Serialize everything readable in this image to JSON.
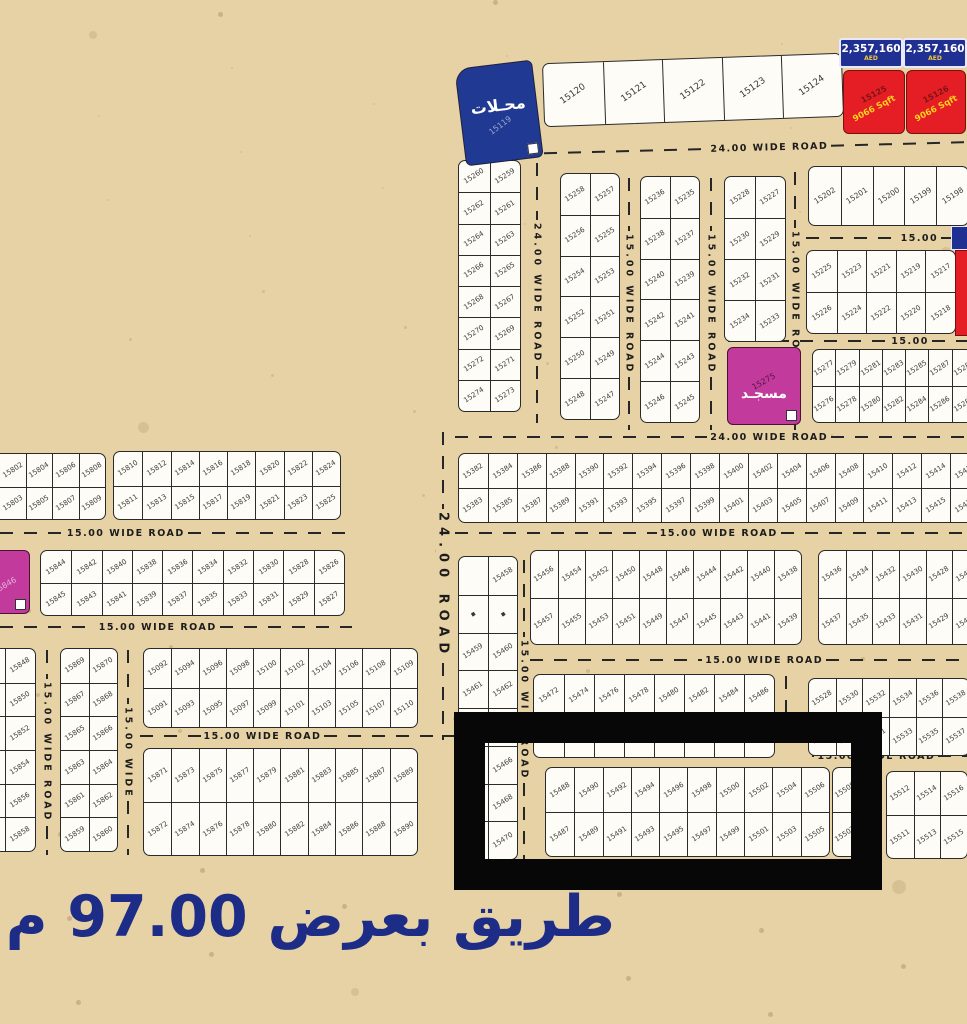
{
  "map": {
    "width": 967,
    "height": 1024,
    "bg_color": "#e7d2a5",
    "plot_color": "#fdfcf6",
    "accent_navy": "#203092",
    "accent_red": "#e41e24",
    "accent_magenta": "#c23a9c"
  },
  "caption": {
    "text": "طريق بعرض 97.00 م",
    "color": "#1c2c87"
  },
  "shops": {
    "label": "محـلات",
    "num": "15119",
    "x": 460,
    "y": 64,
    "w": 78,
    "h": 98,
    "rot": -7
  },
  "mosque": {
    "label": "مسجـد",
    "num": "15275",
    "x": 727,
    "y": 347,
    "w": 74,
    "h": 78,
    "rot": 0
  },
  "facility": {
    "num": "15846",
    "x": -20,
    "y": 550,
    "w": 50,
    "h": 64,
    "rot": 0
  },
  "red_plots": [
    {
      "num": "15125",
      "area": "9066 Sqft",
      "x": 843,
      "y": 70,
      "w": 62,
      "h": 64
    },
    {
      "num": "15126",
      "area": "9066 Sqft",
      "x": 906,
      "y": 70,
      "w": 60,
      "h": 64
    }
  ],
  "prices": [
    {
      "amount": "2,357,160",
      "currency": "AED",
      "x": 839,
      "y": 38,
      "w": 64,
      "h": 30
    },
    {
      "amount": "2,357,160",
      "currency": "AED",
      "x": 903,
      "y": 38,
      "w": 64,
      "h": 30
    }
  ],
  "edge_plot": {
    "tag": {
      "x": 951,
      "y": 226,
      "w": 16,
      "h": 22
    },
    "red": {
      "x": 955,
      "y": 250,
      "w": 12,
      "h": 84
    }
  },
  "highlight_frame": {
    "x": 454,
    "y": 712,
    "w": 428,
    "h": 178
  },
  "roads": [
    {
      "o": "h",
      "x": 520,
      "y": 148,
      "len": 447,
      "label": "24.00 WIDE ROAD",
      "lx": 58,
      "rot": -1.5
    },
    {
      "o": "h",
      "x": 455,
      "y": 437,
      "len": 512,
      "label": "24.00 WIDE ROAD",
      "lx": 65
    },
    {
      "o": "v",
      "x": 537,
      "y": 163,
      "len": 260,
      "label": "24.00 WIDE ROAD"
    },
    {
      "o": "v",
      "x": 629,
      "y": 178,
      "len": 252,
      "label": "15.00 WIDE ROAD"
    },
    {
      "o": "v",
      "x": 711,
      "y": 178,
      "len": 252,
      "label": "15.00 WIDE ROAD"
    },
    {
      "o": "v",
      "x": 795,
      "y": 172,
      "len": 258,
      "label": "15.00 WIDE ROAD"
    },
    {
      "o": "h",
      "x": 806,
      "y": 238,
      "len": 161,
      "label": "15.00",
      "lx": 78
    },
    {
      "o": "h",
      "x": 728,
      "y": 341,
      "len": 239,
      "label": "15.00",
      "lx": 82
    },
    {
      "o": "h",
      "x": 0,
      "y": 533,
      "len": 352,
      "label": "15.00 WIDE ROAD",
      "lx": 28
    },
    {
      "o": "h",
      "x": 0,
      "y": 627,
      "len": 352,
      "label": "15.00 WIDE ROAD",
      "lx": 42
    },
    {
      "o": "v",
      "x": 47,
      "y": 650,
      "len": 205,
      "label": "15.00 WIDE ROAD"
    },
    {
      "o": "v",
      "x": 128,
      "y": 650,
      "len": 205,
      "label": "15.00 WIDE"
    },
    {
      "o": "h",
      "x": 140,
      "y": 736,
      "len": 340,
      "label": "15.00 WIDE ROAD",
      "lx": 28
    },
    {
      "o": "v",
      "x": 443,
      "y": 432,
      "len": 308,
      "label": "24.00 ROAD",
      "big": true
    },
    {
      "o": "h",
      "x": 455,
      "y": 533,
      "len": 512,
      "label": "15.00 WIDE ROAD",
      "lx": 52
    },
    {
      "o": "h",
      "x": 530,
      "y": 660,
      "len": 437,
      "label": "15.00 WIDE ROAD",
      "lx": 55
    },
    {
      "o": "v",
      "x": 524,
      "y": 560,
      "len": 300,
      "label": "15.00 WIDE ROAD"
    },
    {
      "o": "v",
      "x": 786,
      "y": 676,
      "len": 72,
      "label": ""
    },
    {
      "o": "h",
      "x": 812,
      "y": 756,
      "len": 155,
      "label": "15.00 WIDE ROAD",
      "lx": 8
    }
  ],
  "blocks": [
    {
      "id": "top-row",
      "x": 543,
      "y": 58,
      "w": 300,
      "h": 64,
      "fs": 9,
      "rot": -2,
      "rows": [
        [
          "15120",
          "15121",
          "15122",
          "15123",
          "15124"
        ]
      ]
    },
    {
      "id": "nw-1",
      "x": 458,
      "y": 160,
      "w": 63,
      "h": 252,
      "rows": [
        [
          "15260",
          "15259"
        ],
        [
          "15262",
          "15261"
        ],
        [
          "15264",
          "15263"
        ],
        [
          "15266",
          "15265"
        ],
        [
          "15268",
          "15267"
        ],
        [
          "15270",
          "15269"
        ],
        [
          "15272",
          "15271"
        ],
        [
          "15274",
          "15273"
        ]
      ]
    },
    {
      "id": "nw-2",
      "x": 560,
      "y": 173,
      "w": 60,
      "h": 247,
      "rows": [
        [
          "15258",
          "15257"
        ],
        [
          "15256",
          "15255"
        ],
        [
          "15254",
          "15253"
        ],
        [
          "15252",
          "15251"
        ],
        [
          "15250",
          "15249"
        ],
        [
          "15248",
          "15247"
        ]
      ]
    },
    {
      "id": "nw-3",
      "x": 640,
      "y": 176,
      "w": 60,
      "h": 247,
      "rows": [
        [
          "15236",
          "15235"
        ],
        [
          "15238",
          "15237"
        ],
        [
          "15240",
          "15239"
        ],
        [
          "15242",
          "15241"
        ],
        [
          "15244",
          "15243"
        ],
        [
          "15246",
          "15245"
        ]
      ]
    },
    {
      "id": "nw-4",
      "x": 724,
      "y": 176,
      "w": 62,
      "h": 166,
      "rows": [
        [
          "15228",
          "15227"
        ],
        [
          "15230",
          "15229"
        ],
        [
          "15232",
          "15231"
        ],
        [
          "15234",
          "15233"
        ]
      ]
    },
    {
      "id": "ne-row",
      "x": 808,
      "y": 166,
      "w": 161,
      "h": 60,
      "fs": 7.5,
      "rows": [
        [
          "15202",
          "15201",
          "15200",
          "15199",
          "15198"
        ]
      ]
    },
    {
      "id": "ne-grid",
      "x": 806,
      "y": 250,
      "w": 150,
      "h": 84,
      "rows": [
        [
          "15225",
          "15223",
          "15221",
          "15219",
          "15217"
        ],
        [
          "15226",
          "15224",
          "15222",
          "15220",
          "15218"
        ]
      ]
    },
    {
      "id": "mosque-row",
      "x": 812,
      "y": 349,
      "w": 161,
      "h": 74,
      "rows": [
        [
          "15277",
          "15279",
          "15281",
          "15283",
          "15285",
          "15287",
          "15289"
        ],
        [
          "15276",
          "15278",
          "15280",
          "15282",
          "15284",
          "15286",
          "15288"
        ]
      ]
    },
    {
      "id": "w-1",
      "x": -28,
      "y": 453,
      "w": 134,
      "h": 67,
      "rows": [
        [
          "",
          "15802",
          "15804",
          "15806",
          "15808"
        ],
        [
          "",
          "15803",
          "15805",
          "15807",
          "15809"
        ]
      ]
    },
    {
      "id": "w-2",
      "x": 113,
      "y": 451,
      "w": 228,
      "h": 69,
      "rows": [
        [
          "15810",
          "15812",
          "15814",
          "15816",
          "15818",
          "15820",
          "15822",
          "15824"
        ],
        [
          "15811",
          "15813",
          "15815",
          "15817",
          "15819",
          "15821",
          "15823",
          "15825"
        ]
      ]
    },
    {
      "id": "w-3",
      "x": 40,
      "y": 550,
      "w": 305,
      "h": 66,
      "rows": [
        [
          "15844",
          "15842",
          "15840",
          "15838",
          "15836",
          "15834",
          "15832",
          "15830",
          "15828",
          "15826"
        ],
        [
          "15845",
          "15843",
          "15841",
          "15839",
          "15837",
          "15835",
          "15833",
          "15831",
          "15829",
          "15827"
        ]
      ]
    },
    {
      "id": "sw-edge",
      "x": -26,
      "y": 648,
      "w": 62,
      "h": 204,
      "rows": [
        [
          "",
          "15848"
        ],
        [
          "",
          "15850"
        ],
        [
          "",
          "15852"
        ],
        [
          "",
          "15854"
        ],
        [
          "",
          "15856"
        ],
        [
          "",
          "15858"
        ]
      ]
    },
    {
      "id": "sw-pair",
      "x": 60,
      "y": 648,
      "w": 58,
      "h": 204,
      "rows": [
        [
          "15869",
          "15870"
        ],
        [
          "15867",
          "15868"
        ],
        [
          "15865",
          "15866"
        ],
        [
          "15863",
          "15864"
        ],
        [
          "15861",
          "15862"
        ],
        [
          "15859",
          "15860"
        ]
      ]
    },
    {
      "id": "sw-wide-1",
      "x": 143,
      "y": 648,
      "w": 275,
      "h": 80,
      "rows": [
        [
          "15092",
          "15094",
          "15096",
          "15098",
          "15100",
          "15102",
          "15104",
          "15106",
          "15108",
          "15109"
        ],
        [
          "15091",
          "15093",
          "15095",
          "15097",
          "15099",
          "15101",
          "15103",
          "15105",
          "15107",
          "15110"
        ]
      ]
    },
    {
      "id": "sw-wide-2",
      "x": 143,
      "y": 748,
      "w": 275,
      "h": 108,
      "rows": [
        [
          "15871",
          "15873",
          "15875",
          "15877",
          "15879",
          "15881",
          "15883",
          "15885",
          "15887",
          "15889"
        ],
        [
          "15872",
          "15874",
          "15876",
          "15878",
          "15880",
          "15882",
          "15884",
          "15886",
          "15888",
          "15890"
        ]
      ]
    },
    {
      "id": "mid-long",
      "x": 458,
      "y": 453,
      "w": 522,
      "h": 70,
      "rows": [
        [
          "15382",
          "15384",
          "15386",
          "15388",
          "15390",
          "15392",
          "15394",
          "15396",
          "15398",
          "15400",
          "15402",
          "15404",
          "15406",
          "15408",
          "15410",
          "15412",
          "15414",
          "15416"
        ],
        [
          "15383",
          "15385",
          "15387",
          "15389",
          "15391",
          "15393",
          "15395",
          "15397",
          "15399",
          "15401",
          "15403",
          "15405",
          "15407",
          "15409",
          "15411",
          "15413",
          "15415",
          "15417"
        ]
      ]
    },
    {
      "id": "mid-pair",
      "x": 458,
      "y": 556,
      "w": 60,
      "h": 304,
      "rows": [
        [
          "",
          "15458"
        ],
        [
          "▪",
          "▪"
        ],
        [
          "15459",
          "15460"
        ],
        [
          "15461",
          "15462"
        ],
        [
          "15463",
          "15464"
        ],
        [
          "15465",
          "15466"
        ],
        [
          "15467",
          "15468"
        ],
        [
          "15469",
          "15470"
        ]
      ]
    },
    {
      "id": "mid-main",
      "x": 530,
      "y": 550,
      "w": 272,
      "h": 95,
      "rows": [
        [
          "15456",
          "15454",
          "15452",
          "15450",
          "15448",
          "15446",
          "15444",
          "15442",
          "15440",
          "15438"
        ],
        [
          "15457",
          "15455",
          "15453",
          "15451",
          "15449",
          "15447",
          "15445",
          "15443",
          "15441",
          "15439"
        ]
      ]
    },
    {
      "id": "mid-right",
      "x": 818,
      "y": 550,
      "w": 162,
      "h": 95,
      "rows": [
        [
          "15436",
          "15434",
          "15432",
          "15430",
          "15428",
          "15426"
        ],
        [
          "15437",
          "15435",
          "15433",
          "15431",
          "15429",
          "15427"
        ]
      ]
    },
    {
      "id": "low-mid",
      "x": 533,
      "y": 674,
      "w": 242,
      "h": 84,
      "rows": [
        [
          "15472",
          "15474",
          "15476",
          "15478",
          "15480",
          "15482",
          "15484",
          "15486"
        ],
        [
          "",
          "",
          "",
          "",
          "",
          "",
          "",
          ""
        ]
      ]
    },
    {
      "id": "low-right",
      "x": 808,
      "y": 678,
      "w": 162,
      "h": 78,
      "rows": [
        [
          "15528",
          "15530",
          "15532",
          "15534",
          "15536",
          "15538"
        ],
        [
          "15527",
          "15529",
          "15531",
          "15533",
          "15535",
          "15537"
        ]
      ]
    },
    {
      "id": "frame-main",
      "x": 545,
      "y": 767,
      "w": 285,
      "h": 90,
      "rows": [
        [
          "15488",
          "15490",
          "15492",
          "15494",
          "15496",
          "15498",
          "15500",
          "15502",
          "15504",
          "15506"
        ],
        [
          "15487",
          "15489",
          "15491",
          "15493",
          "15495",
          "15497",
          "15499",
          "15501",
          "15503",
          "15505"
        ]
      ]
    },
    {
      "id": "frame-col",
      "x": 832,
      "y": 767,
      "w": 26,
      "h": 90,
      "rows": [
        [
          "15508"
        ],
        [
          "15507"
        ]
      ]
    },
    {
      "id": "frame-right",
      "x": 886,
      "y": 771,
      "w": 82,
      "h": 88,
      "rows": [
        [
          "15512",
          "15514",
          "15516"
        ],
        [
          "15511",
          "15513",
          "15515"
        ]
      ]
    }
  ]
}
